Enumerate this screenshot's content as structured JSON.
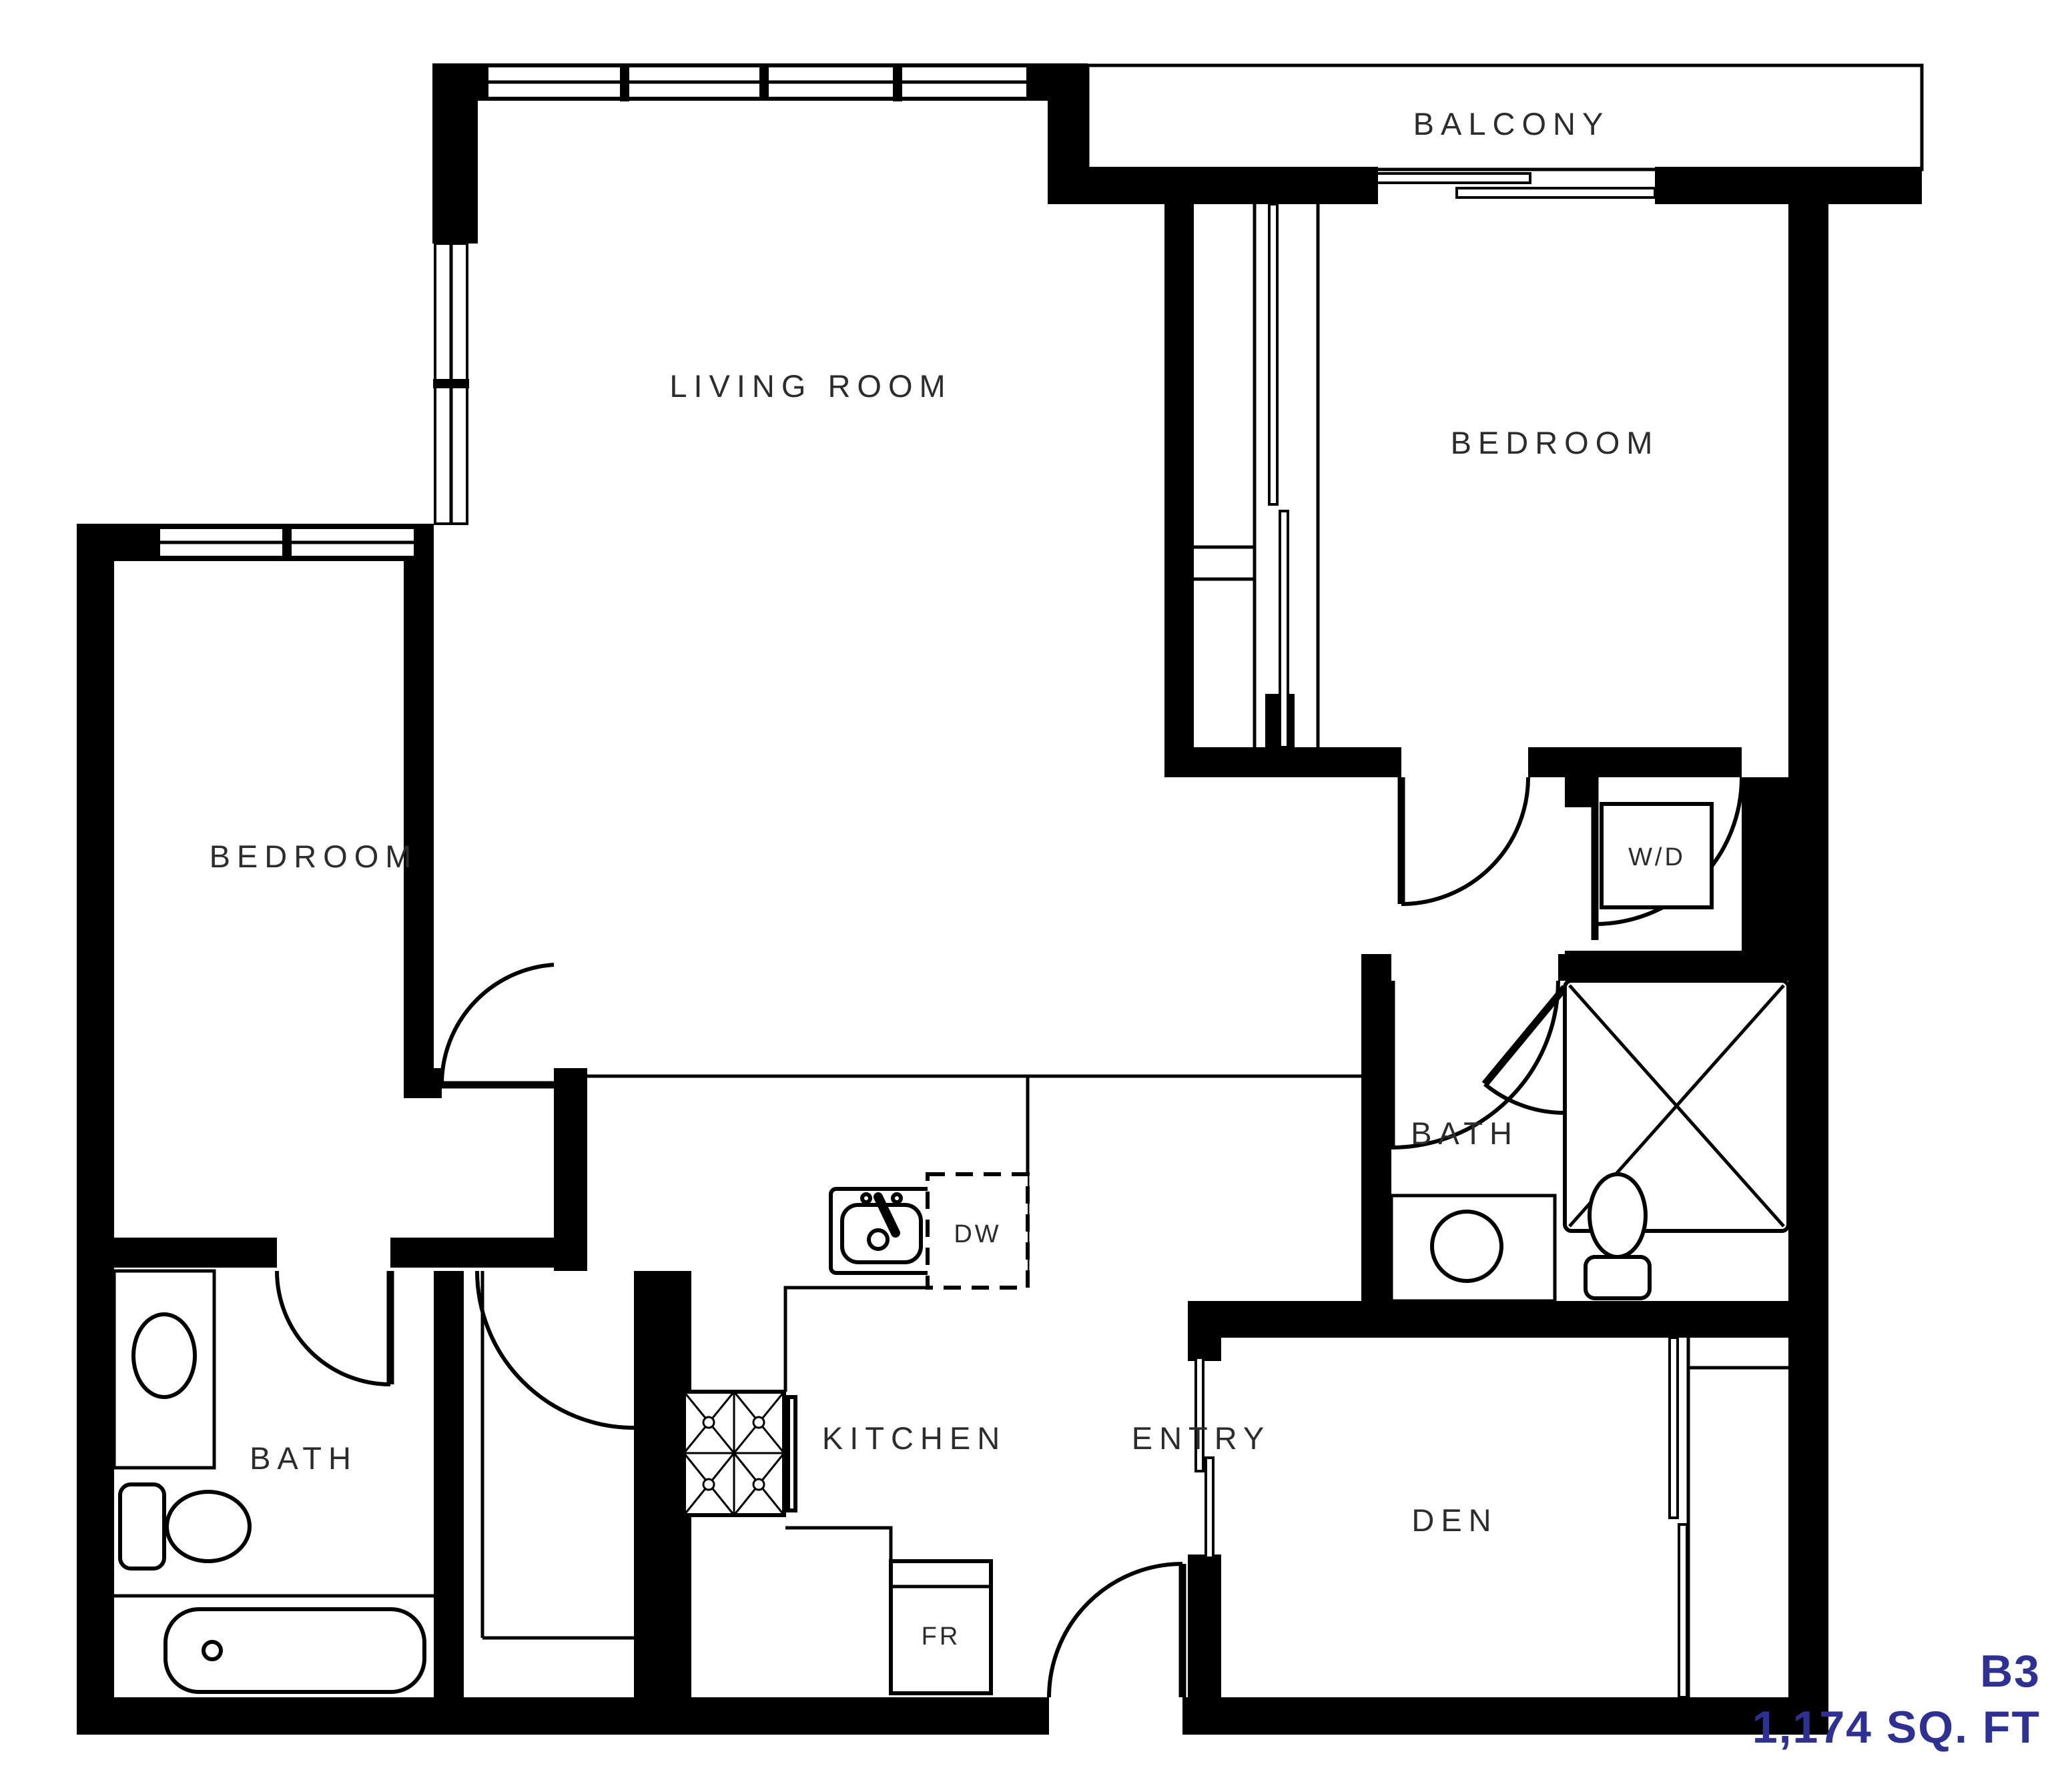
{
  "plan": {
    "unit_name": "B3",
    "area": "1,174 SQ. FT",
    "accent_color": "#2e3192",
    "wall_color": "#000000"
  },
  "rooms": {
    "balcony": {
      "label": "BALCONY"
    },
    "living_room": {
      "label": "LIVING ROOM"
    },
    "bedroom_right": {
      "label": "BEDROOM"
    },
    "bedroom_left": {
      "label": "BEDROOM"
    },
    "bath_right": {
      "label": "BATH"
    },
    "bath_left": {
      "label": "BATH"
    },
    "kitchen": {
      "label": "KITCHEN"
    },
    "entry": {
      "label": "ENTRY"
    },
    "den": {
      "label": "DEN"
    }
  },
  "fixtures": {
    "washer_dryer": {
      "label": "W/D"
    },
    "dishwasher": {
      "label": "DW"
    },
    "fridge": {
      "label": "FR"
    }
  }
}
